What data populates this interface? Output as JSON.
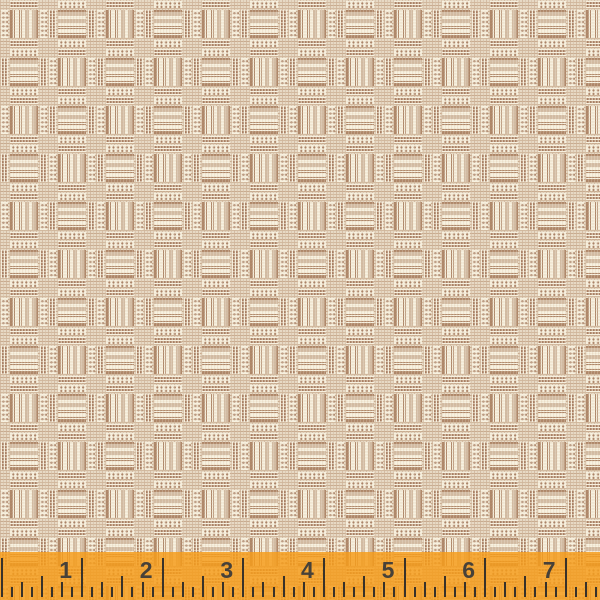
{
  "image": {
    "description": "Woven plaid fabric swatch: checkerboard of cream blocks with vertical and horizontal brown double-stripes, separated by dotted bands, striped comb bands and tan crosshatch weave; semi-transparent orange inch ruler overlaid along the bottom edge.",
    "width_px": 600,
    "height_px": 600
  },
  "palette": {
    "cream": "#f7f0de",
    "weave_base": "#e7d9c4",
    "stripe_brown": "#ae8769",
    "band_brown": "#a87f63",
    "dot_brown": "#aa8266",
    "hairline": "rgba(247,240,222,0.55)",
    "ruler_orange": "rgba(245,156,26,0.84)",
    "tick_color": "#38322a",
    "number_color": "#474139"
  },
  "fabric": {
    "cell_px": 48,
    "grid_cols": 13,
    "grid_rows": 13,
    "block_types": [
      "vertical-stripes",
      "horizontal-stripes"
    ],
    "checkerboard_even_type": "vertical-stripes"
  },
  "ruler": {
    "numbers": [
      "1",
      "2",
      "3",
      "4",
      "5",
      "6",
      "7"
    ],
    "origin_x": 1.5,
    "pixels_per_inch": 80.6,
    "ticks_per_inch": 8,
    "max_x": 598,
    "number_offset_from_tick": -16.5,
    "overlay_top": 552,
    "overlay_height": 48,
    "tick_heights": {
      "inch": 39,
      "half": 21,
      "quarter": 15,
      "eighth": 10
    }
  }
}
